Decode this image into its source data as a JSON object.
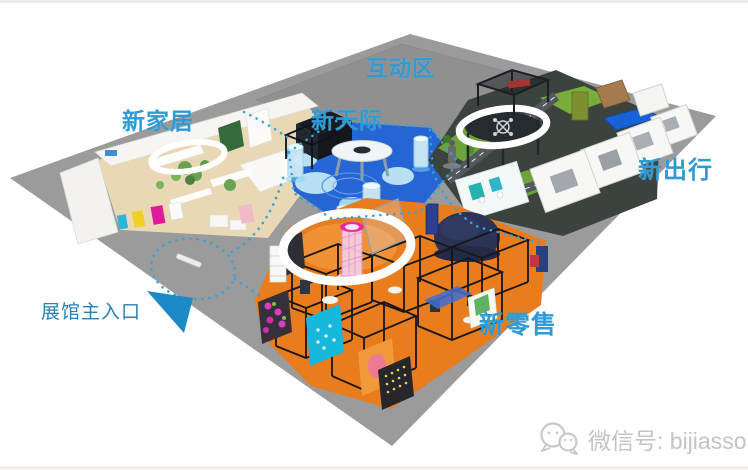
{
  "image": {
    "kind": "3d-exhibition-floorplan",
    "background": "#ffffff"
  },
  "zones": {
    "interactive": {
      "label": "互动区"
    },
    "home": {
      "label": "新家居"
    },
    "sky": {
      "label": "新天际"
    },
    "mobility": {
      "label": "新出行"
    },
    "retail": {
      "label": "新零售"
    }
  },
  "entrance": {
    "label": "展馆主入口"
  },
  "watermark": {
    "wechat_label": "微信号: bijiasso",
    "icon": "wechat-icon"
  },
  "colors": {
    "label_blue": "#2f9bd4",
    "entrance_label_blue": "#2d7fb0",
    "entrance_arrow_blue": "#1b8ac6",
    "platform_gray": "#9b9b9b",
    "plateau_gray": "#909090",
    "home_floor_tan": "#e9d8b6",
    "sky_floor_blue": "#2565d4",
    "mobility_floor_dark": "#3c433e",
    "mobility_lawn_green": "#6ea33c",
    "retail_floor_orange": "#e97c1d",
    "ring_white": "#ffffff",
    "path_dots_blue": "#35a3dc",
    "watermark_gray": "#c4c4c4"
  }
}
